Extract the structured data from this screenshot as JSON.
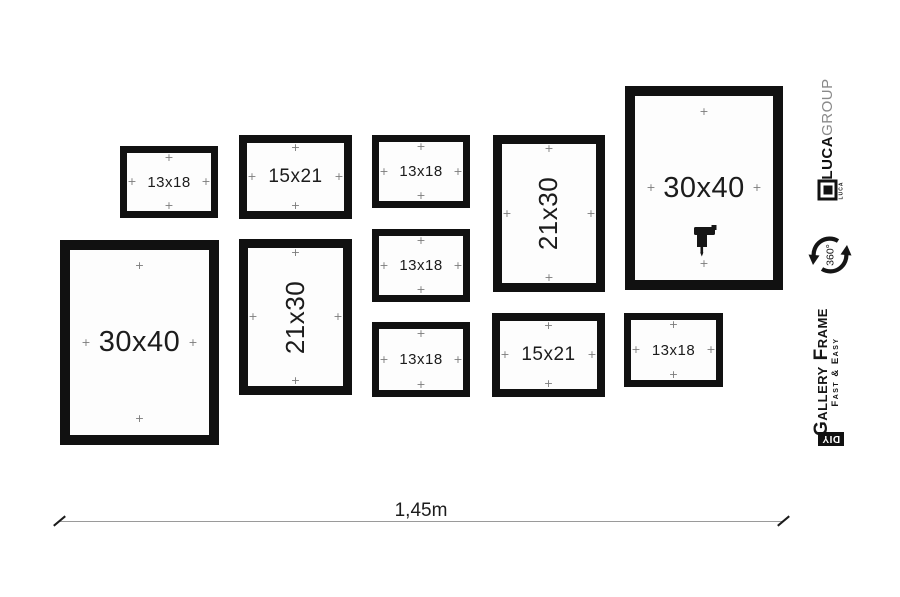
{
  "diagram": {
    "name": "gallery-wall-hanging-layout",
    "frames": [
      {
        "label": "13x18",
        "orientation": "landscape"
      },
      {
        "label": "15x21",
        "orientation": "landscape"
      },
      {
        "label": "13x18",
        "orientation": "landscape"
      },
      {
        "label": "21x30",
        "orientation": "portrait"
      },
      {
        "label": "30x40",
        "orientation": "portrait"
      },
      {
        "label": "30x40",
        "orientation": "portrait"
      },
      {
        "label": "21x30",
        "orientation": "portrait"
      },
      {
        "label": "13x18",
        "orientation": "landscape"
      },
      {
        "label": "13x18",
        "orientation": "landscape"
      },
      {
        "label": "15x21",
        "orientation": "landscape"
      },
      {
        "label": "13x18",
        "orientation": "landscape"
      }
    ],
    "dimension": {
      "label": "1,45m"
    }
  },
  "branding": {
    "brand_bold": "LUCA",
    "brand_light": "GROUP",
    "logo_small_text": "LUCA",
    "rotation_label": "360°",
    "product_name": "Gallery Frame",
    "product_tagline": "Fast & Easy",
    "diy_badge": "DIY"
  },
  "icons": {
    "hanging_point_icon": "+",
    "drill_icon": "power-drill",
    "rotation_360_icon": "circular-arrows"
  },
  "colors": {
    "frame_border": "#111111",
    "cross_gray": "#7b7b7b",
    "dimension_line": "#9a9a9a",
    "badge_bg": "#111111",
    "brand_light_gray": "#8a8a8a"
  }
}
